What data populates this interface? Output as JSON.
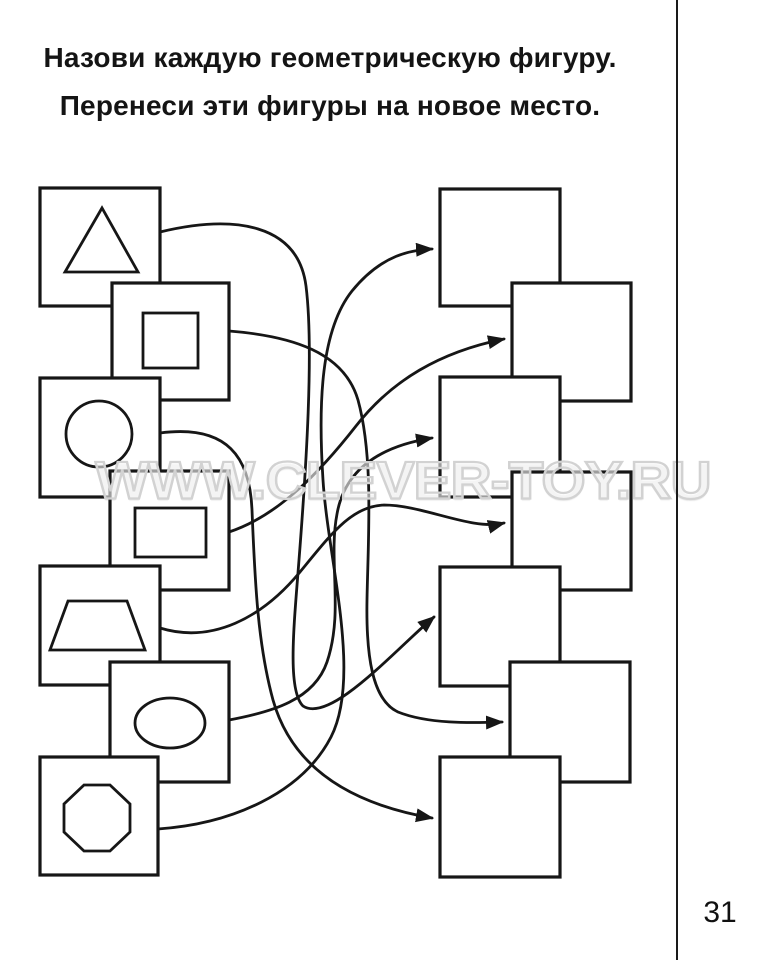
{
  "title": {
    "line1": "Назови каждую геометрическую фигуру.",
    "line2": "Перенеси эти фигуры на новое место."
  },
  "worksheet": {
    "source_shapes": [
      {
        "id": 1,
        "shape": "triangle"
      },
      {
        "id": 2,
        "shape": "square"
      },
      {
        "id": 3,
        "shape": "circle"
      },
      {
        "id": 4,
        "shape": "rectangle"
      },
      {
        "id": 5,
        "shape": "trapezoid"
      },
      {
        "id": 6,
        "shape": "oval"
      },
      {
        "id": 7,
        "shape": "octagon"
      }
    ],
    "target_boxes": [
      {
        "id": 1,
        "content": "empty"
      },
      {
        "id": 2,
        "content": "empty"
      },
      {
        "id": 3,
        "content": "empty"
      },
      {
        "id": 4,
        "content": "empty"
      },
      {
        "id": 5,
        "content": "empty"
      },
      {
        "id": 6,
        "content": "empty"
      },
      {
        "id": 7,
        "content": "empty"
      }
    ],
    "arrow_connections": [
      {
        "from": "triangle",
        "to_target": 5
      },
      {
        "from": "square",
        "to_target": 6
      },
      {
        "from": "circle",
        "to_target": 7
      },
      {
        "from": "rectangle",
        "to_target": 2
      },
      {
        "from": "trapezoid",
        "to_target": 4
      },
      {
        "from": "oval",
        "to_target": 3
      },
      {
        "from": "octagon",
        "to_target": 1
      }
    ]
  },
  "watermark": {
    "text": "WWW.CLEVER-TOY.RU"
  },
  "page": {
    "number": "31"
  },
  "colors": {
    "ink": "#161616",
    "watermark_gray": "#d2d2d2",
    "paper": "#ffffff"
  }
}
